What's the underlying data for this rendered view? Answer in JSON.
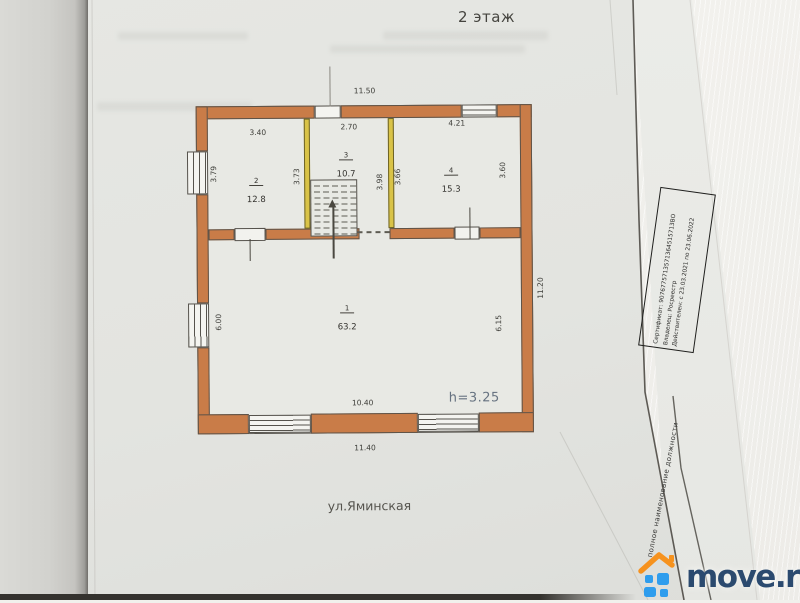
{
  "header": {
    "floor_title": "2 этаж"
  },
  "plan": {
    "street_label": "ул.Яминская",
    "rooms": [
      {
        "number": "1",
        "area": "63.2"
      },
      {
        "number": "2",
        "area": "12.8"
      },
      {
        "number": "3",
        "area": "10.7"
      },
      {
        "number": "4",
        "area": "15.3"
      }
    ],
    "dims": {
      "top_total": "11.50",
      "room2_width": "3.40",
      "room3_width": "2.70",
      "room4_width": "4.21",
      "room2_depth_left": "3.79",
      "room2_depth_right": "3.73",
      "hall3_depth": "3.98",
      "room4_depth_left": "3.66",
      "room4_depth_right": "3.60",
      "room1_depth_left": "6.00",
      "room1_depth_right": "6.15",
      "room1_width": "10.40",
      "bottom_total": "11.40",
      "right_total": "11.20",
      "ceiling_height": "h=3.25"
    },
    "colors": {
      "outer_wall": "#c97c48",
      "partition_wall": "#d9c347"
    }
  },
  "stamp": {
    "line1": "Сертификат: 9076775713571364515713ВО",
    "line2": "Владелец: Росреестр",
    "line3": "Действителен: с 23.03.2021 по 23.06.2022"
  },
  "signature_note": "полное наименование должности",
  "watermark": {
    "brand": "move.ru",
    "colors": {
      "roof": "#f6921e",
      "squares": "#2f9ded",
      "text": "#2b4a6f"
    }
  }
}
